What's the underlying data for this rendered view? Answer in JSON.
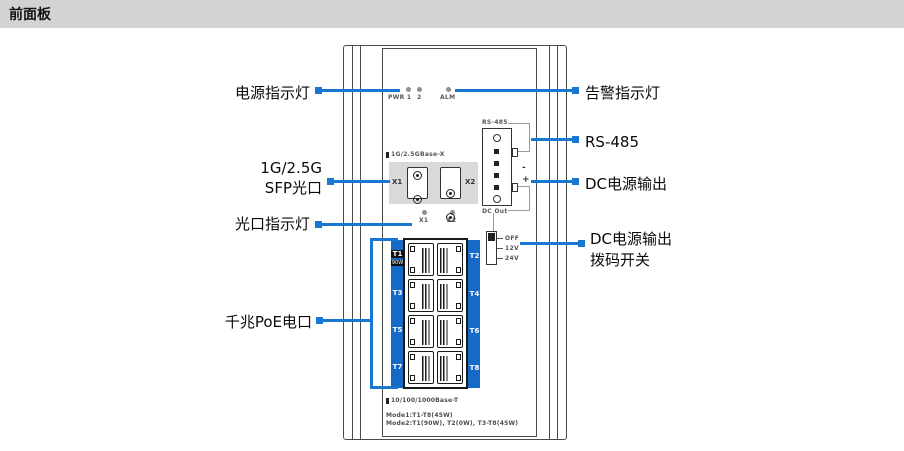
{
  "header": {
    "title": "前面板"
  },
  "colors": {
    "accent": "#1777d1",
    "poe_blue": "#1569c7",
    "panel_gray": "#d9d9d9",
    "header_gray": "#d3d3d3",
    "outline": "#4a4a4a"
  },
  "callouts": {
    "power_led": "电源指示灯",
    "sfp_line1": "1G/2.5G",
    "sfp_line2": "SFP光口",
    "optical_led": "光口指示灯",
    "poe_ports": "千兆PoE电口",
    "alarm_led": "告警指示灯",
    "rs485": "RS-485",
    "dc_output": "DC电源输出",
    "dip_line1": "DC电源输出",
    "dip_line2": "拨码开关"
  },
  "device": {
    "leds": {
      "pwr": "PWR 1",
      "pwr2": "2",
      "alm": "ALM"
    },
    "terminal": {
      "top": "RS-485",
      "bottom": "DC Out",
      "minus": "-",
      "plus": "+"
    },
    "sfp": {
      "title": "1G/2.5GBase-X",
      "x1": "X1",
      "x2": "X2",
      "led_x1": "X1",
      "led_x2": "X2"
    },
    "dip": {
      "off": "OFF",
      "v12": "12V",
      "v24": "24V"
    },
    "poe": {
      "ports": [
        "T1",
        "T2",
        "T3",
        "T4",
        "T5",
        "T6",
        "T7",
        "T8"
      ],
      "t1_badge": "90W",
      "base_t": "10/100/1000Base-T",
      "mode1": "Mode1:T1-T8(45W)",
      "mode2": "Mode2:T1(90W), T2(0W), T3-T8(45W)"
    }
  }
}
